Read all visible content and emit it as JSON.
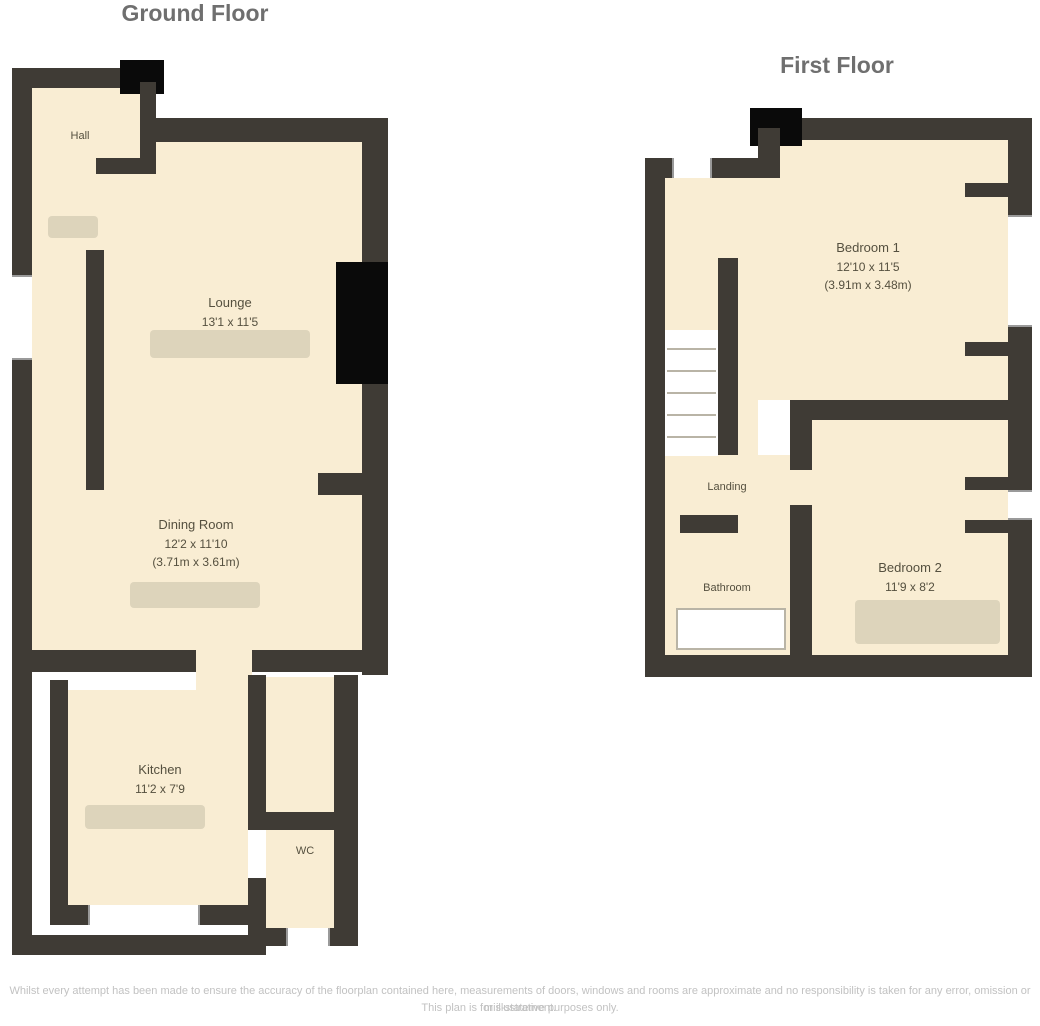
{
  "ground_floor": {
    "title": "Ground Floor",
    "rooms": {
      "hall": {
        "name": "Hall"
      },
      "lounge": {
        "name": "Lounge",
        "dims_imperial": "13'1 x 11'5",
        "dims_metric": "(3.99m x 3.48m)"
      },
      "dining": {
        "name": "Dining Room",
        "dims_imperial": "12'2 x 11'10",
        "dims_metric": "(3.71m x 3.61m)"
      },
      "kitchen": {
        "name": "Kitchen",
        "dims_imperial": "11'2 x 7'9",
        "dims_metric": "(3.40m x 2.36m)"
      },
      "wc": {
        "name": "WC"
      }
    }
  },
  "first_floor": {
    "title": "First Floor",
    "rooms": {
      "landing": {
        "name": "Landing"
      },
      "bedroom1": {
        "name": "Bedroom 1",
        "dims_imperial": "12'10 x 11'5",
        "dims_metric": "(3.91m x 3.48m)"
      },
      "bedroom2": {
        "name": "Bedroom 2",
        "dims_imperial": "11'9 x 8'2",
        "dims_metric": "(3.58m x 2.49m)"
      },
      "bathroom": {
        "name": "Bathroom"
      }
    }
  },
  "footer": {
    "line1": "Whilst every attempt has been made to ensure the accuracy of the floorplan contained here, measurements of doors, windows and rooms are approximate and no responsibility is taken for any error, omission or mis-statement.",
    "line2": "This plan is for illustrative purposes only."
  },
  "colors": {
    "wall": "#3f3b35",
    "room_fill": "#f9edd3",
    "chimney_solid": "#0a0a0a",
    "title_text": "#6f6f6f",
    "label_text": "#55503f",
    "disclaimer_text": "#c2c2c2"
  }
}
